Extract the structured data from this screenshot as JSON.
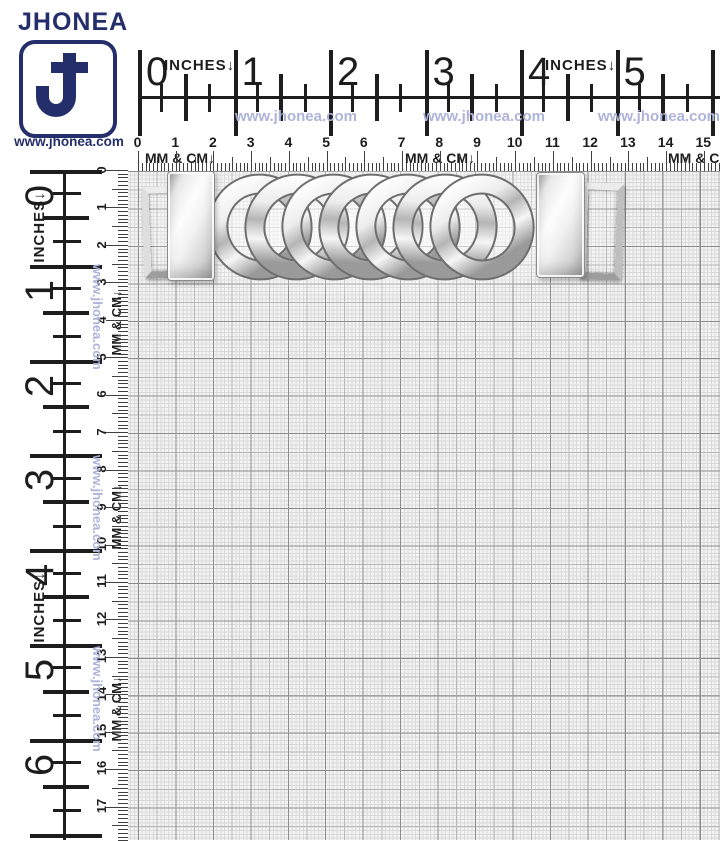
{
  "brand": {
    "name": "JHONEA",
    "website": "www.jhonea.com",
    "monogram_letter": "J",
    "navy": "#232e6b"
  },
  "watermark": {
    "text": "www.jhonea.com",
    "color": "#aeb3da"
  },
  "rulers": {
    "inches_label": "INCHES↓",
    "mm_cm_label": "MM & CM↓",
    "ink_color": "#1d1d1d",
    "top": {
      "inch_numbers": [
        "0",
        "1",
        "2",
        "3",
        "4",
        "5",
        "6"
      ],
      "cm_numbers": [
        "0",
        "1",
        "2",
        "3",
        "4",
        "5",
        "6",
        "7",
        "8",
        "9",
        "10",
        "11",
        "12",
        "13",
        "14",
        "15"
      ]
    },
    "left": {
      "inch_numbers": [
        "0",
        "1",
        "2",
        "3",
        "4",
        "5",
        "6"
      ],
      "cm_numbers": [
        "0",
        "1",
        "2",
        "3",
        "4",
        "5",
        "6",
        "7",
        "8",
        "9",
        "10",
        "11",
        "12",
        "13",
        "14",
        "15",
        "16",
        "17"
      ]
    }
  },
  "product": {
    "icon": "curb-chain-buckle",
    "metal_light": "#ffffff",
    "metal_mid": "#c9c9c9",
    "metal_dark": "#8f8f8f",
    "link_outline": "#6e6e6e"
  },
  "grid": {
    "background": "#f3f3f3",
    "line_fine": "#d9d9d9",
    "line_medium": "#b8b8b8",
    "line_bold": "#8c8c8c"
  }
}
